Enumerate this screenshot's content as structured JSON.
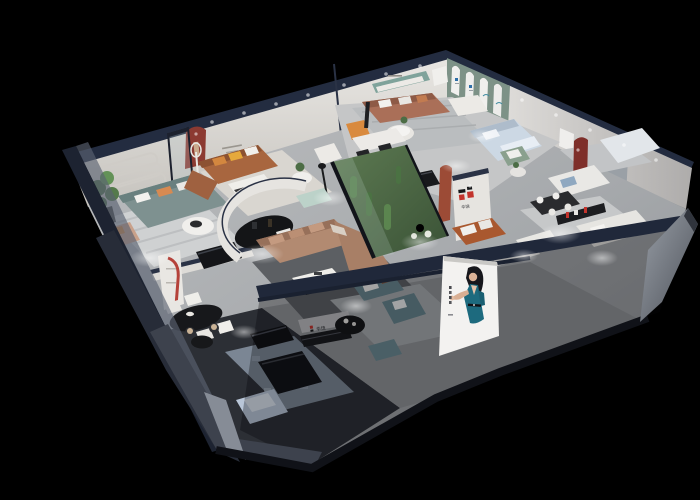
{
  "scene": {
    "kind": "isometric-3d-showroom-cutaway-render",
    "background_color": "#000000",
    "brand": {
      "name": "华饶",
      "logo_mark": "H",
      "logo_red": "#c2332c",
      "logo_black": "#17181a",
      "pier_label": "华饶",
      "reception_label": "华饶"
    },
    "poster": {
      "description": "model in teal dress gesturing, white panel on storefront",
      "panel_color": "#f3f2f0",
      "dress_color": "#1d6a7e",
      "hair_color": "#17171c",
      "skin_color": "#dcb297"
    },
    "palette": {
      "wall_white": "#dcdad6",
      "wall_edge_navy": "#232c40",
      "floor_light": "#b4b6b8",
      "floor_dark": "#2c2f35",
      "arch_wall_green": "#7d9287",
      "niche_red": "#8c3a32",
      "sofa_brown": "#aa6f58",
      "sofa_caramel": "#a8663f",
      "sofa_tan": "#b28a71",
      "sofa_sage": "#7e9190",
      "sofa_teal": "#68858e",
      "sofa_white": "#e9e8e5",
      "bed_blue": "#ccd8e4",
      "accent_orange": "#d98a3e",
      "plant_green": "#4c6d45",
      "exterior_slate": "#3d424d"
    }
  }
}
